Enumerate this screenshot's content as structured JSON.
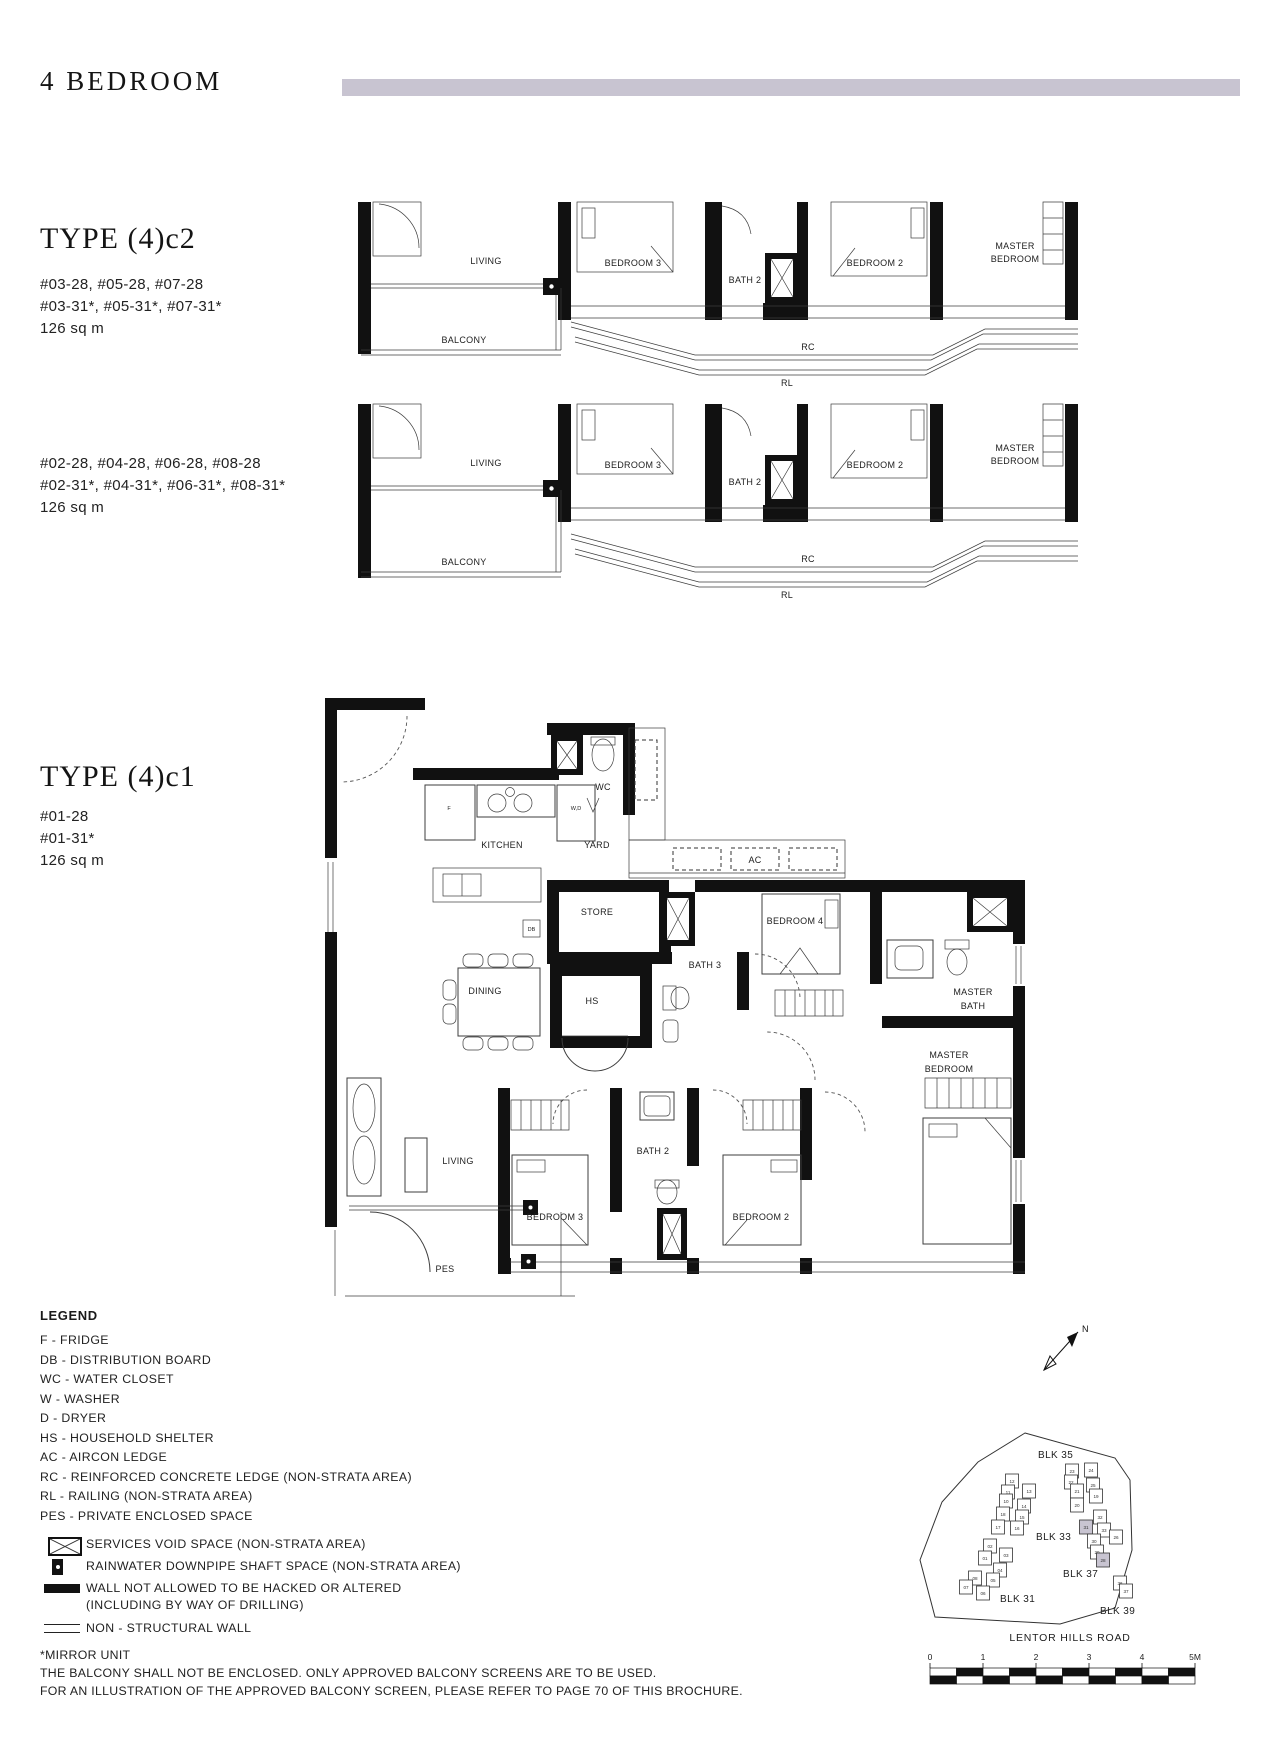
{
  "header": {
    "title": "4 BEDROOM"
  },
  "colors": {
    "accent": "#c8c4d1"
  },
  "type_c2": {
    "title": "TYPE (4)c2",
    "variant_a": {
      "units_line1": "#03-28, #05-28, #07-28",
      "units_line2": "#03-31*, #05-31*, #07-31*",
      "area": "126 sq m"
    },
    "variant_b": {
      "units_line1": "#02-28, #04-28, #06-28, #08-28",
      "units_line2": "#02-31*, #04-31*, #06-31*, #08-31*",
      "area": "126 sq m"
    },
    "labels": {
      "living": "LIVING",
      "balcony": "BALCONY",
      "bedroom3": "BEDROOM 3",
      "bath2": "BATH 2",
      "bedroom2": "BEDROOM 2",
      "master1": "MASTER",
      "master2": "BEDROOM",
      "rc": "RC",
      "rl": "RL"
    }
  },
  "type_c1": {
    "title": "TYPE (4)c1",
    "units_line1": "#01-28",
    "units_line2": "#01-31*",
    "area": "126 sq m",
    "labels": {
      "kitchen": "KITCHEN",
      "yard": "YARD",
      "wc": "WC",
      "ac": "AC",
      "f": "F",
      "wd": "W,D",
      "db": "DB",
      "store": "STORE",
      "dining": "DINING",
      "hs": "HS",
      "bath3": "BATH 3",
      "bedroom4": "BEDROOM 4",
      "masterbath1": "MASTER",
      "masterbath2": "BATH",
      "living": "LIVING",
      "bedroom3": "BEDROOM 3",
      "bath2": "BATH 2",
      "bedroom2": "BEDROOM 2",
      "master1": "MASTER",
      "master2": "BEDROOM",
      "pes": "PES"
    }
  },
  "legend": {
    "title": "LEGEND",
    "items": [
      "F - FRIDGE",
      "DB - DISTRIBUTION BOARD",
      "WC - WATER CLOSET",
      "W - WASHER",
      "D - DRYER",
      "HS - HOUSEHOLD SHELTER",
      "AC - AIRCON LEDGE",
      "RC - REINFORCED CONCRETE LEDGE (NON-STRATA AREA)",
      "RL - RAILING (NON-STRATA AREA)",
      "PES - PRIVATE ENCLOSED SPACE"
    ],
    "symbol_items": [
      {
        "symbol": "services-void",
        "label": "SERVICES VOID SPACE (NON-STRATA AREA)"
      },
      {
        "symbol": "rainwater-downpipe",
        "label": "RAINWATER DOWNPIPE SHAFT SPACE (NON-STRATA AREA)"
      },
      {
        "symbol": "structural-wall",
        "label": "WALL NOT ALLOWED TO BE HACKED OR ALTERED",
        "label2": "(INCLUDING BY WAY OF DRILLING)"
      },
      {
        "symbol": "non-structural-wall",
        "label": "NON - STRUCTURAL WALL"
      }
    ]
  },
  "notes": {
    "line1": "*MIRROR UNIT",
    "line2": "THE BALCONY SHALL NOT BE ENCLOSED. ONLY APPROVED BALCONY SCREENS ARE TO BE USED.",
    "line3": "FOR AN ILLUSTRATION OF THE APPROVED BALCONY SCREEN, PLEASE REFER TO PAGE 70 OF THIS BROCHURE."
  },
  "site_plan": {
    "blocks": {
      "blk35": "BLK 35",
      "blk33": "BLK 33",
      "blk37": "BLK 37",
      "blk31": "BLK 31",
      "blk39": "BLK 39"
    },
    "road": "LENTOR HILLS ROAD",
    "compass": "N",
    "highlight_color": "#c8c4d1",
    "highlighted_units": [
      "28",
      "31"
    ],
    "scale_labels": [
      "0",
      "1",
      "2",
      "3",
      "4",
      "5M"
    ],
    "units": [
      {
        "n": "23",
        "x": 252,
        "y": 181
      },
      {
        "n": "24",
        "x": 271,
        "y": 180
      },
      {
        "n": "22",
        "x": 251,
        "y": 192
      },
      {
        "n": "25",
        "x": 273,
        "y": 195
      },
      {
        "n": "21",
        "x": 257,
        "y": 201
      },
      {
        "n": "19",
        "x": 276,
        "y": 206
      },
      {
        "n": "20",
        "x": 257,
        "y": 215
      },
      {
        "n": "32",
        "x": 280,
        "y": 227
      },
      {
        "n": "31",
        "x": 266,
        "y": 237,
        "h": true
      },
      {
        "n": "33",
        "x": 284,
        "y": 240
      },
      {
        "n": "26",
        "x": 296,
        "y": 247
      },
      {
        "n": "30",
        "x": 274,
        "y": 251
      },
      {
        "n": "29",
        "x": 277,
        "y": 262
      },
      {
        "n": "28",
        "x": 283,
        "y": 270,
        "h": true
      },
      {
        "n": "36",
        "x": 300,
        "y": 293
      },
      {
        "n": "37",
        "x": 306,
        "y": 301
      },
      {
        "n": "12",
        "x": 192,
        "y": 191
      },
      {
        "n": "11",
        "x": 188,
        "y": 202
      },
      {
        "n": "13",
        "x": 209,
        "y": 201
      },
      {
        "n": "10",
        "x": 186,
        "y": 211
      },
      {
        "n": "14",
        "x": 204,
        "y": 216
      },
      {
        "n": "18",
        "x": 183,
        "y": 224
      },
      {
        "n": "15",
        "x": 202,
        "y": 227
      },
      {
        "n": "17",
        "x": 178,
        "y": 237
      },
      {
        "n": "16",
        "x": 197,
        "y": 238
      },
      {
        "n": "02",
        "x": 170,
        "y": 256
      },
      {
        "n": "01",
        "x": 165,
        "y": 268
      },
      {
        "n": "03",
        "x": 186,
        "y": 265
      },
      {
        "n": "04",
        "x": 180,
        "y": 280
      },
      {
        "n": "08",
        "x": 155,
        "y": 288
      },
      {
        "n": "05",
        "x": 173,
        "y": 290
      },
      {
        "n": "07",
        "x": 146,
        "y": 297
      },
      {
        "n": "06",
        "x": 163,
        "y": 303
      }
    ]
  }
}
